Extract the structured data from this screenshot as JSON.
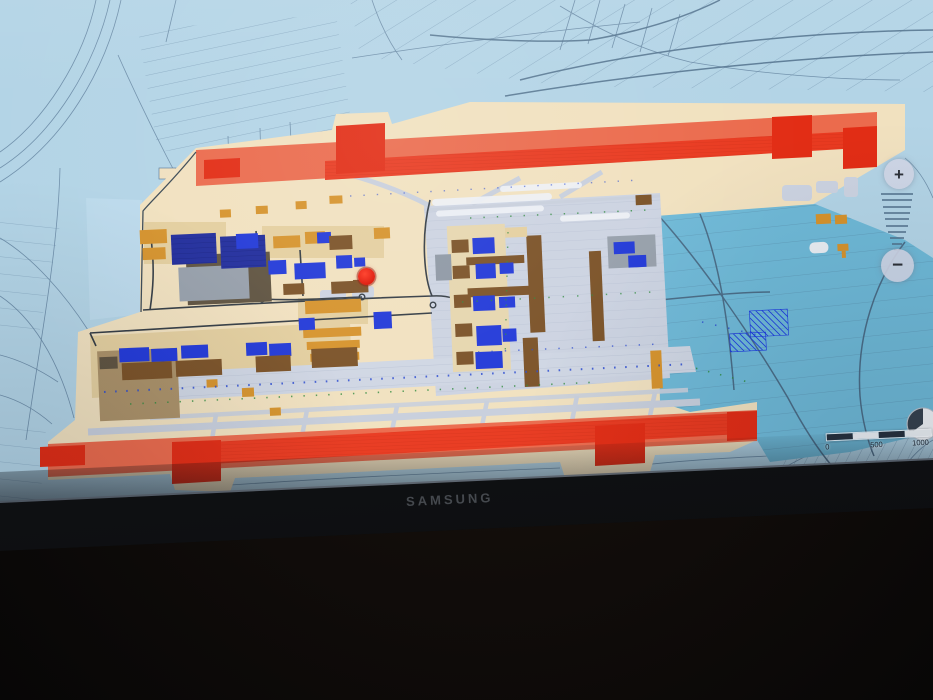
{
  "device": {
    "brand": "SAMSUNG"
  },
  "map": {
    "type": "airport-master-plan-over-cadastral-map",
    "controls": {
      "zoom_in": "+",
      "zoom_out": "−"
    },
    "scale_bar": {
      "labels": [
        "0",
        "500",
        "1000"
      ]
    },
    "marker_color": "#e21507",
    "palette": {
      "background_parcels": "#b3d4e6",
      "parcel_lines": "#5f7f9c",
      "airport_grounds": "#f1e1bf",
      "inner_reserve_zone": "#6fb9d7",
      "runway_strip": "#eb6b4d",
      "runway": "#e93a20",
      "runway_blocks": "#e22d15",
      "apron": "#ccd3e1",
      "buildings_blue": "#2239d8",
      "buildings_navy": "#202c9c",
      "buildings_brown": "#7b5227",
      "buildings_orange": "#d6932c",
      "roads": "#343c44"
    }
  }
}
